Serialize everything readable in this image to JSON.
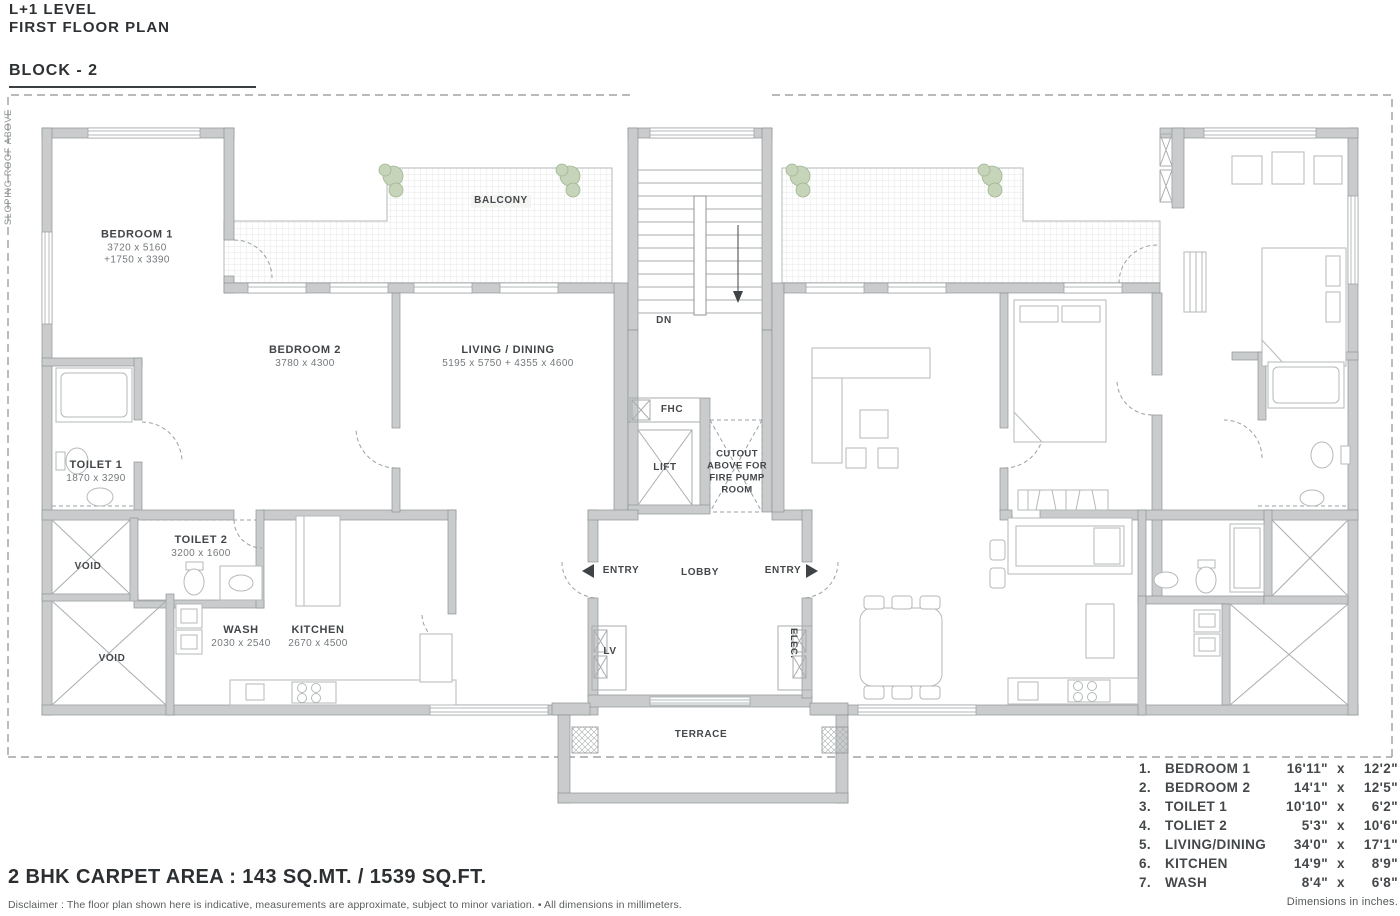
{
  "header": {
    "line1": "L+1 LEVEL",
    "line2": "FIRST FLOOR PLAN",
    "block": "BLOCK - 2"
  },
  "side_note": "SLOPING ROOF ABOVE",
  "plan": {
    "bedroom1": {
      "name": "BEDROOM 1",
      "dim1": "3720 x 5160",
      "dim2": "+1750 x 3390"
    },
    "bedroom2": {
      "name": "BEDROOM 2",
      "dim": "3780 x 4300"
    },
    "living": {
      "name": "LIVING / DINING",
      "dim": "5195 x 5750 + 4355 x 4600"
    },
    "toilet1": {
      "name": "TOILET 1",
      "dim": "1870 x 3290"
    },
    "toilet2": {
      "name": "TOILET 2",
      "dim": "3200 x 1600"
    },
    "wash": {
      "name": "WASH",
      "dim": "2030 x 2540"
    },
    "kitchen": {
      "name": "KITCHEN",
      "dim": "2670 x 4500"
    },
    "balcony": "BALCONY",
    "void1": "VOID",
    "void2": "VOID",
    "terrace": "TERRACE",
    "lobby": "LOBBY",
    "entry_left": "ENTRY",
    "entry_right": "ENTRY",
    "lift": "LIFT",
    "fhc": "FHC",
    "lv": "LV",
    "elec": "ELEC.",
    "dn": "DN",
    "cutout": [
      "CUTOUT",
      "ABOVE FOR",
      "FIRE PUMP",
      "ROOM"
    ]
  },
  "legend": {
    "rows": [
      {
        "no": "1.",
        "name": "BEDROOM 1",
        "w": "16'11\"",
        "x": "x",
        "h": "12'2\""
      },
      {
        "no": "2.",
        "name": "BEDROOM 2",
        "w": "14'1\"",
        "x": "x",
        "h": "12'5\""
      },
      {
        "no": "3.",
        "name": "TOILET 1",
        "w": "10'10\"",
        "x": "x",
        "h": "6'2\""
      },
      {
        "no": "4.",
        "name": "TOLIET 2",
        "w": "5'3\"",
        "x": "x",
        "h": "10'6\""
      },
      {
        "no": "5.",
        "name": "LIVING/DINING",
        "w": "34'0\"",
        "x": "x",
        "h": "17'1\""
      },
      {
        "no": "6.",
        "name": "KITCHEN",
        "w": "14'9\"",
        "x": "x",
        "h": "8'9\""
      },
      {
        "no": "7.",
        "name": "WASH",
        "w": "8'4\"",
        "x": "x",
        "h": "6'8\""
      }
    ],
    "note": "Dimensions in inches."
  },
  "footer": {
    "area": "2 BHK CARPET AREA : 143 SQ.MT. / 1539 SQ.FT.",
    "disclaimer": "Disclaimer : The floor plan shown here is indicative, measurements are approximate, subject to minor variation. • All dimensions in millimeters."
  }
}
